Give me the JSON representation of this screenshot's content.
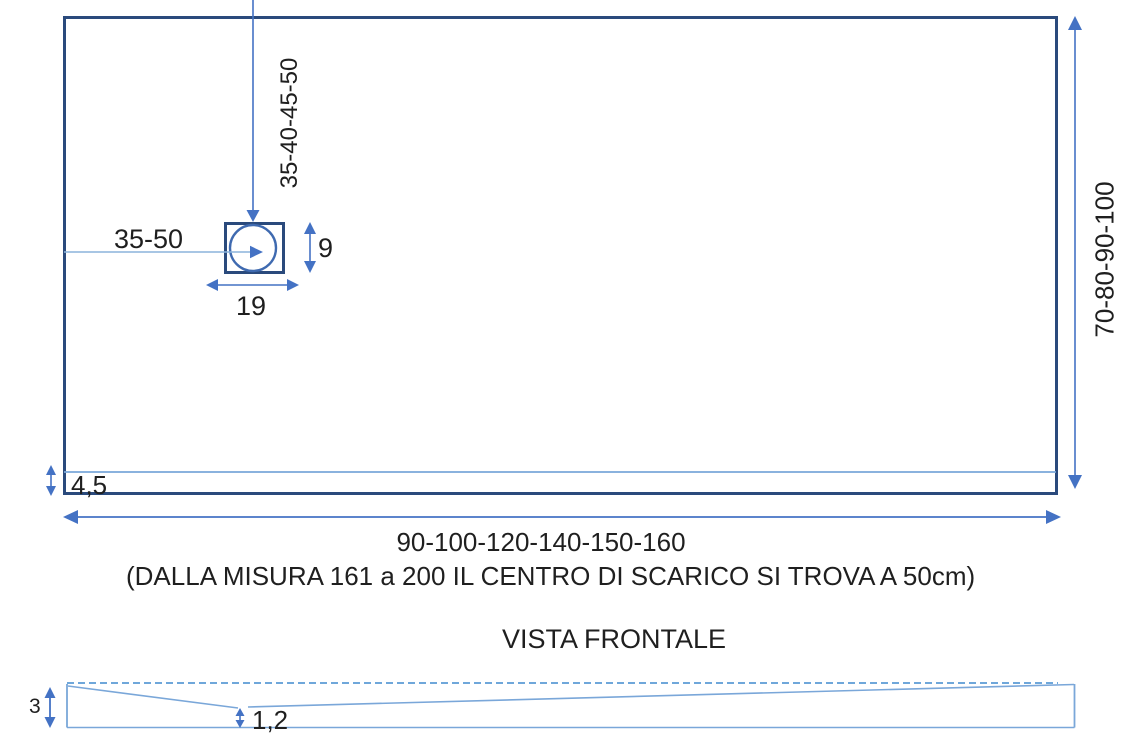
{
  "diagram": {
    "top_view": {
      "drain_center_from_top_label": "35-40-45-50",
      "drain_center_from_left_label": "35-50",
      "drain_box_height_label": "9",
      "drain_box_width_label": "19",
      "depth_range_label": "70-80-90-100",
      "front_ledge_height_label": "4,5",
      "width_range_label": "90-100-120-140-150-160",
      "note": "(DALLA MISURA 161 a 200 IL CENTRO DI SCARICO SI TROVA A 50cm)"
    },
    "front_view": {
      "title": "VISTA FRONTALE",
      "edge_thickness_label": "3",
      "center_thickness_label": "1,2"
    },
    "colors": {
      "outline_dark": "#2a4a7c",
      "dimension_blue": "#4472c4",
      "light_blue": "#7aa7d9",
      "text": "#1f1f1f"
    }
  }
}
